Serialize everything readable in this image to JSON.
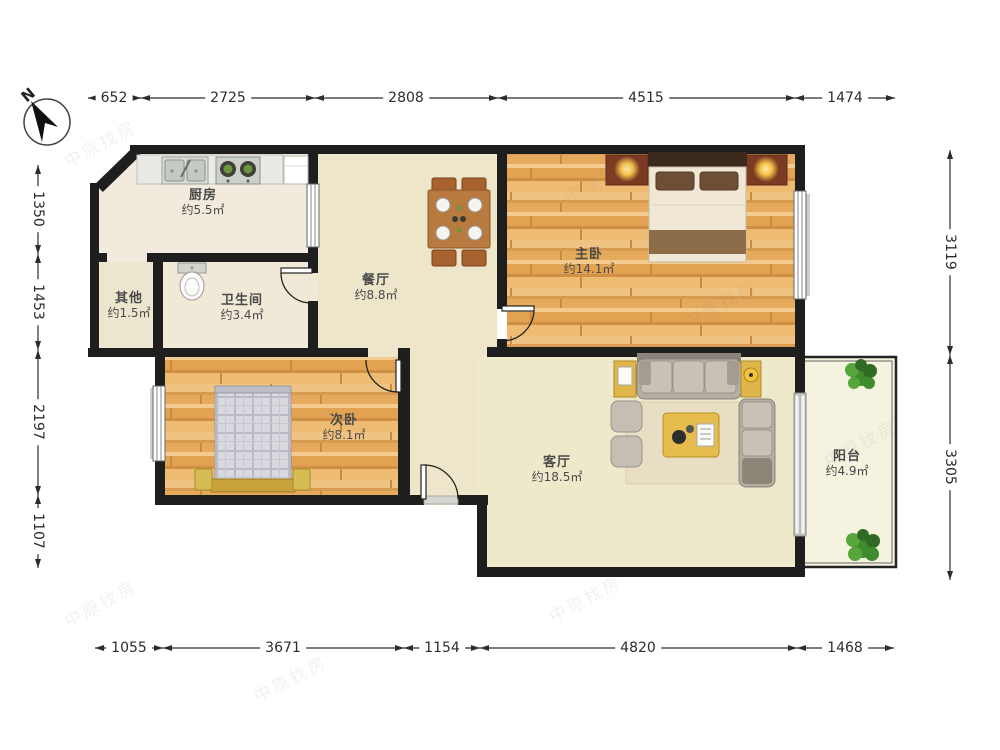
{
  "compass": {
    "label": "N"
  },
  "watermark": {
    "text": "中原找房"
  },
  "rooms": [
    {
      "id": "kitchen",
      "name": "厨房",
      "area": "约5.5㎡"
    },
    {
      "id": "other",
      "name": "其他",
      "area": "约1.5㎡"
    },
    {
      "id": "bathroom",
      "name": "卫生间",
      "area": "约3.4㎡"
    },
    {
      "id": "dining",
      "name": "餐厅",
      "area": "约8.8㎡"
    },
    {
      "id": "master",
      "name": "主卧",
      "area": "约14.1㎡"
    },
    {
      "id": "second",
      "name": "次卧",
      "area": "约8.1㎡"
    },
    {
      "id": "living",
      "name": "客厅",
      "area": "约18.5㎡"
    },
    {
      "id": "balcony",
      "name": "阳台",
      "area": "约4.9㎡"
    }
  ],
  "dimensions": {
    "top": [
      "652",
      "2725",
      "2808",
      "4515",
      "1474"
    ],
    "bottom": [
      "1055",
      "3671",
      "1154",
      "4820",
      "1468"
    ],
    "left": [
      "1350",
      "1453",
      "2197",
      "1107"
    ],
    "right": [
      "3119",
      "3305"
    ]
  },
  "colors": {
    "wall": "#1e1e1e",
    "wood": "#e9b267",
    "floor_beige": "#ede6ca",
    "accent_yellow": "#e0b64b"
  }
}
